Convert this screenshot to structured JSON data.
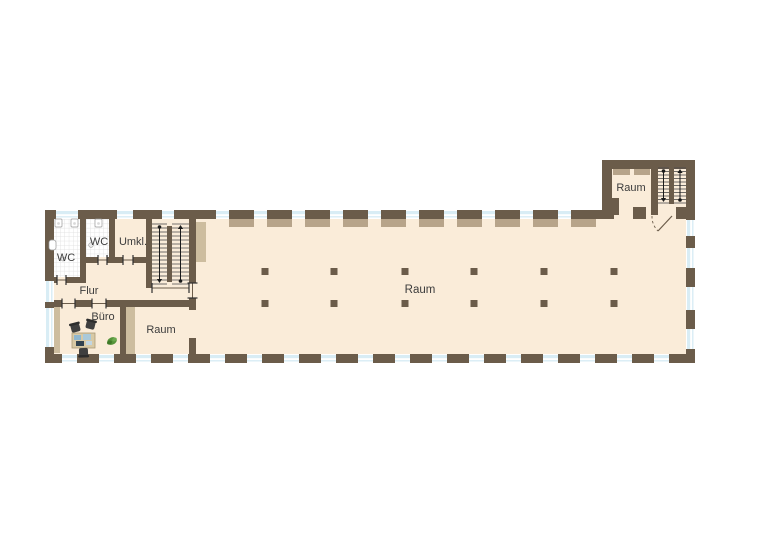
{
  "rooms": {
    "wc1": {
      "label": "WC"
    },
    "wc2": {
      "label": "WC"
    },
    "umkl": {
      "label": "Umkl."
    },
    "flur": {
      "label": "Flur"
    },
    "buero": {
      "label": "Büro"
    },
    "raum_klein": {
      "label": "Raum"
    },
    "raum_halle": {
      "label": "Raum"
    },
    "raum_annex": {
      "label": "Raum"
    }
  },
  "colors": {
    "wall": "#6b5c4a",
    "floor": "#faecd9",
    "window_glass": "#d9edf5",
    "window_frame": "#ffffff",
    "lintel": "#b7a48a",
    "shaft": "#cdbd9f",
    "tile_line": "#dcdcdc",
    "tile": "#ffffff",
    "label": "#3c3c3c",
    "stair_line": "#4a4a4a",
    "arrow": "#1a1a1a",
    "chair": "#3f3f3f",
    "desk": "#d8c9a5",
    "desk_border": "#a99a78",
    "paper_blue": "#8fb7cf",
    "paper_blue2": "#a9c9da",
    "monitor": "#31424f",
    "plant": "#55943a",
    "plant_dark": "#3f7a28",
    "fixture": "#ffffff",
    "fixture_border": "#9a9a9a"
  }
}
